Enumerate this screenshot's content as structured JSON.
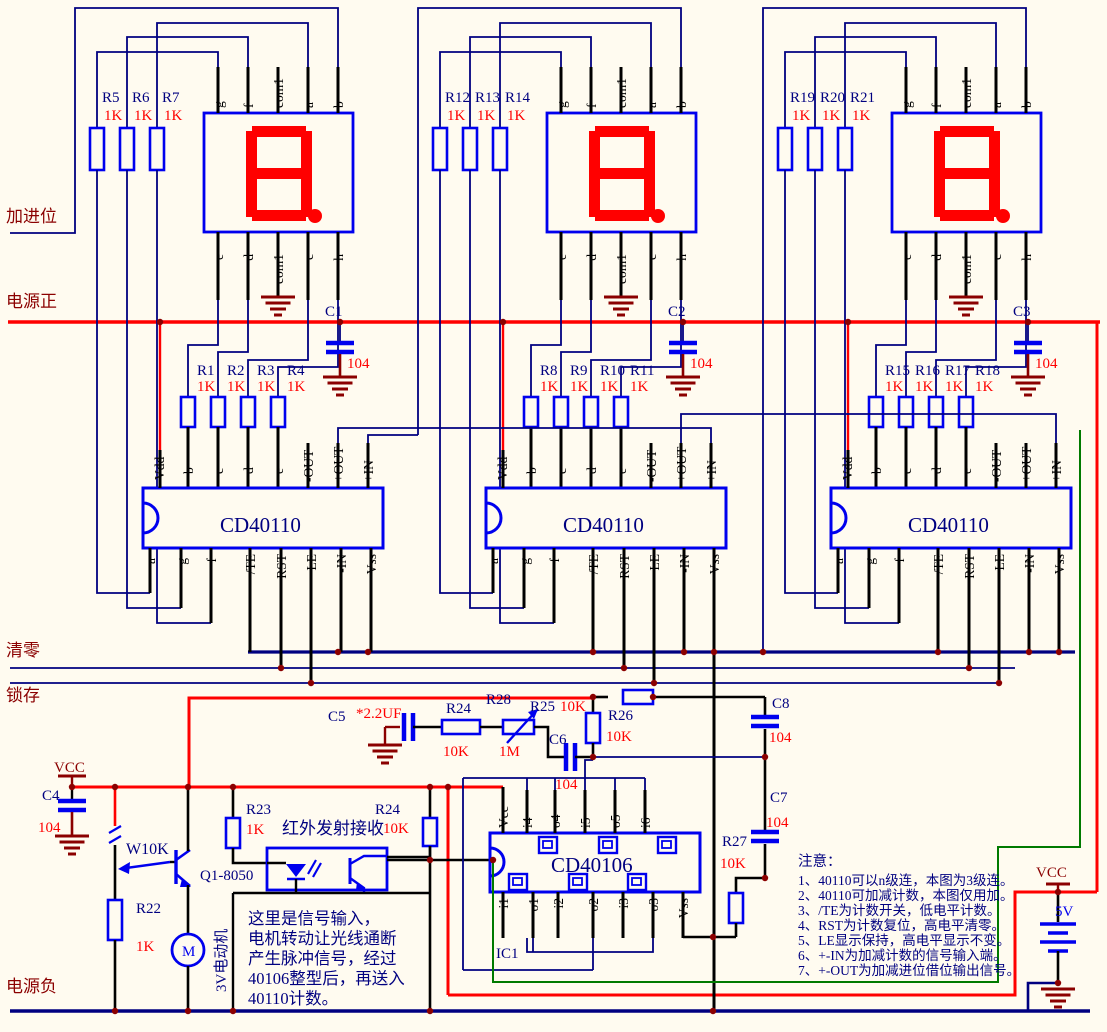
{
  "colors": {
    "bg": "#FFFBF0",
    "component_blue": "#0000EE",
    "wire_navy": "#000080",
    "wire_red": "#FF0000",
    "dark_red": "#8B0000",
    "wire_green": "#007A00",
    "pin_black": "#000000",
    "digit_red": "#FF0000"
  },
  "buses": {
    "carry_in": "加进位",
    "power_pos": "电源正",
    "clear": "清零",
    "latch": "锁存",
    "power_neg": "电源负"
  },
  "display_pins": {
    "top": [
      "g",
      "f",
      "com1",
      "a",
      "b"
    ],
    "bottom": [
      "e",
      "d",
      "com1",
      "c",
      "h"
    ]
  },
  "counter": {
    "label": "CD40110",
    "pins_top": [
      "Vdd",
      "b",
      "c",
      "d",
      "e",
      "-OUT",
      "+OUT",
      "+IN"
    ],
    "pins_bottom": [
      "a",
      "g",
      "f",
      "/TE",
      "RST",
      "LE",
      "-IN",
      "Vss"
    ]
  },
  "blocks": [
    {
      "seg_resistors": [
        "R5",
        "R6",
        "R7"
      ],
      "digit_resistors": [
        "R1",
        "R2",
        "R3",
        "R4"
      ],
      "cap": "C1"
    },
    {
      "seg_resistors": [
        "R12",
        "R13",
        "R14"
      ],
      "digit_resistors": [
        "R8",
        "R9",
        "R10",
        "R11"
      ],
      "cap": "C2"
    },
    {
      "seg_resistors": [
        "R19",
        "R20",
        "R21"
      ],
      "digit_resistors": [
        "R15",
        "R16",
        "R17",
        "R18"
      ],
      "cap": "C3"
    }
  ],
  "resistor_value": "1K",
  "cap_value": "104",
  "gate_ic": {
    "label": "CD40106",
    "ref": "IC1",
    "pins_top": [
      "Vcc",
      "i4",
      "o4",
      "i5",
      "o5",
      "i6"
    ],
    "pins_bottom": [
      "i1",
      "o1",
      "i2",
      "o2",
      "i3",
      "o3",
      "Vss"
    ]
  },
  "rc": {
    "c5": {
      "ref": "C5",
      "value": "*2.2UF"
    },
    "r24a": {
      "ref": "R24",
      "value": "10K"
    },
    "r28": {
      "ref": "R28",
      "value": "1M"
    },
    "r25": {
      "ref": "R25",
      "value": "10K"
    },
    "r26": {
      "ref": "R26",
      "value": "10K"
    },
    "c6": {
      "ref": "C6",
      "value": "104"
    },
    "c8": {
      "ref": "C8",
      "value": "104"
    },
    "c7": {
      "ref": "C7",
      "value": "104"
    },
    "r27": {
      "ref": "R27",
      "value": "10K"
    }
  },
  "input_stage": {
    "vcc": "VCC",
    "c4": {
      "ref": "C4",
      "value": "104"
    },
    "pot": "W10K",
    "r22": {
      "ref": "R22",
      "value": "1K"
    },
    "transistor": "Q1-8050",
    "motor": "M",
    "motor_label": "3V电动机",
    "r23": {
      "ref": "R23",
      "value": "1K"
    },
    "r24b": {
      "ref": "R24",
      "value": "10K"
    },
    "opto_label": "红外发射接收",
    "note_lines": [
      "这里是信号输入，",
      "电机转动让光线通断",
      "产生脉冲信号，经过",
      "40106整型后，再送入",
      "40110计数。"
    ]
  },
  "power_right": {
    "vcc": "VCC",
    "voltage": "5V"
  },
  "notes": {
    "title": "注意：",
    "items": [
      "1、40110可以n级连，本图为3级连。",
      "2、40110可加减计数，本图仅用加。",
      "3、/TE为计数开关，低电平计数。",
      "4、RST为计数复位，高电平清零。",
      "5、LE显示保持，高电平显示不变。",
      "6、+-IN为加减计数的信号输入端。",
      "7、+-OUT为加减进位借位输出信号。"
    ]
  }
}
